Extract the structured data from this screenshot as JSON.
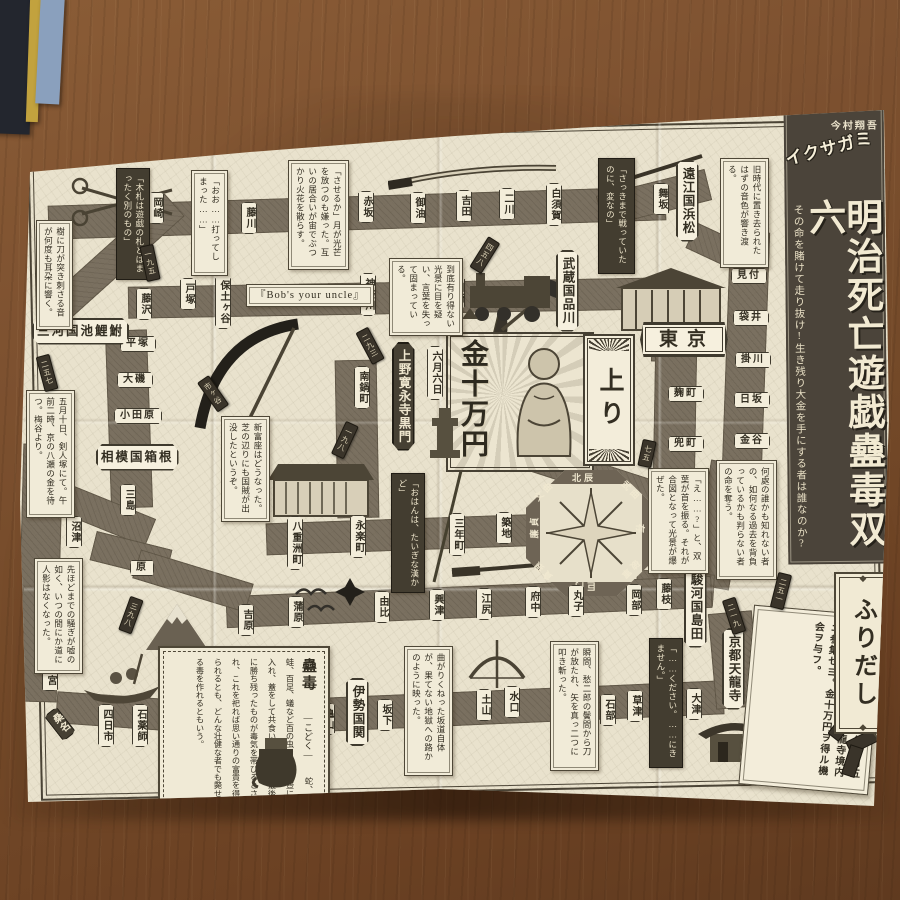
{
  "title": {
    "author": "今村翔吾",
    "series": "イクサガミ",
    "main": "明治死亡遊戯蠱毒双六",
    "subtitle": "その命を賭けて走り抜け!生き残り大金を手にする者は誰なのか?"
  },
  "start": {
    "label": "ふりだし",
    "instruction": "武技ニ優レタル者。本年五月五日、午前零時、京都天龍寺境内ニ参集セヨ。金十万円ヲ得ル機会ヲ与フ。"
  },
  "goal": {
    "prize": "金十万円",
    "date": "六月六日",
    "agari": "上り"
  },
  "compass": {
    "labels": [
      "北辰",
      "武曲",
      "禄存",
      "破軍",
      "巨門",
      "貪狼",
      "廉貞",
      "文曲"
    ]
  },
  "stations": [
    {
      "label": "京都天龍寺"
    },
    {
      "label": "大津"
    },
    {
      "label": "草津"
    },
    {
      "label": "石部"
    },
    {
      "label": "水口"
    },
    {
      "label": "土山"
    },
    {
      "label": "坂下"
    },
    {
      "label": "伊勢国関"
    },
    {
      "label": "亀山"
    },
    {
      "label": "庄野"
    },
    {
      "label": "石薬師"
    },
    {
      "label": "四日市"
    },
    {
      "label": "桑名"
    },
    {
      "label": "宮"
    },
    {
      "label": "鳴海"
    },
    {
      "label": "三河国池鯉鮒"
    },
    {
      "label": "岡崎"
    },
    {
      "label": "藤川"
    },
    {
      "label": "赤坂"
    },
    {
      "label": "御油"
    },
    {
      "label": "吉田"
    },
    {
      "label": "二川"
    },
    {
      "label": "白須賀"
    },
    {
      "label": "新居"
    },
    {
      "label": "舞坂"
    },
    {
      "label": "遠江国浜松"
    },
    {
      "label": "見付"
    },
    {
      "label": "袋井"
    },
    {
      "label": "掛川"
    },
    {
      "label": "日坂"
    },
    {
      "label": "金谷"
    },
    {
      "label": "駿河国島田"
    },
    {
      "label": "藤枝"
    },
    {
      "label": "岡部"
    },
    {
      "label": "丸子"
    },
    {
      "label": "府中"
    },
    {
      "label": "江尻"
    },
    {
      "label": "興津"
    },
    {
      "label": "由比"
    },
    {
      "label": "蒲原"
    },
    {
      "label": "吉原"
    },
    {
      "label": "原"
    },
    {
      "label": "沼津"
    },
    {
      "label": "三島"
    },
    {
      "label": "相模国箱根"
    },
    {
      "label": "小田原"
    },
    {
      "label": "大磯"
    },
    {
      "label": "平塚"
    },
    {
      "label": "藤沢"
    },
    {
      "label": "戸塚"
    },
    {
      "label": "保土ヶ谷"
    },
    {
      "label": "神奈川"
    },
    {
      "label": "川崎"
    },
    {
      "label": "武蔵国品川"
    },
    {
      "label": "東京"
    },
    {
      "label": "麹町"
    },
    {
      "label": "兜町"
    },
    {
      "label": "南鍋町"
    },
    {
      "label": "三年町"
    },
    {
      "label": "築地"
    },
    {
      "label": "永楽町"
    },
    {
      "label": "八重洲町"
    },
    {
      "label": "上野寛永寺黒門"
    }
  ],
  "bubbles": [
    {
      "text": "「おお……打ってしまった……」"
    },
    {
      "text": "「させるか」月が光芒を放つのも嫌った。互いの居合いが宙でぶつかり火花を散らす。"
    },
    {
      "text": "到底有り得ない光景に目を疑い、言葉を失って固まっている。"
    },
    {
      "text": "「さっきまで戦っていたのに、変なの」"
    },
    {
      "text": "旧時代に置き去られたはずの音色が響き渡る。"
    },
    {
      "text": "何處の誰かも知れない者の、如何なる過去を背負っているかも判らない者の命を奪う。"
    },
    {
      "text": "「え……?」と、双葉が首を振る。それが合図となって光景が爆ぜた。"
    },
    {
      "text": "新富座はどうなった。芝の辺りにも国賊が出没したというぞ。"
    },
    {
      "text": "五月十日、剣人塚にて。午前二時、京の八瀬の金を待つ。梅谷より。"
    },
    {
      "text": "先ほどまでの騒ぎが嘘の如く、いつの間にか道に人影はなくなった。"
    },
    {
      "text": "曲がりくねった坂道自体が、果てない地獄への路かのように映った。"
    },
    {
      "text": "瞬間、愁二郎の鬢間から刀が放たれ、矢を真っ二つに叩き斬った。"
    },
    {
      "text": "樹に刀が突き刺さる音が何度も耳朶に響く。"
    },
    {
      "text": "『Bob's your uncle』"
    }
  ],
  "banners": [
    {
      "text": "「木札は遊戯の札とはまったく別のもの」"
    },
    {
      "text": "「おはんは、たいぎな漢かど」"
    },
    {
      "text": "「……ください。……にきません。」"
    }
  ],
  "tags": [
    {
      "num": "二五一"
    },
    {
      "num": "二一九"
    },
    {
      "num": "二九三"
    },
    {
      "num": "一九八"
    },
    {
      "num": "一九五"
    },
    {
      "num": "三九八"
    },
    {
      "num": "四五八"
    },
    {
      "num": "二五七"
    },
    {
      "num": "七五"
    },
    {
      "num": "市ヶ谷"
    }
  ],
  "kodoku": {
    "title": "蠱毒",
    "reading": "―こどく―",
    "body": "蛇、蛙、百足、蟻など百の虫を一つの壺に入れ、蓋をして共食いをさせる。最後に勝ち残ったものが毒気を帯びるとされ、これを祀れば思い通りの富貴を得られるとも、どんな壮健な者でも斃せる毒を作れるともいう。"
  }
}
